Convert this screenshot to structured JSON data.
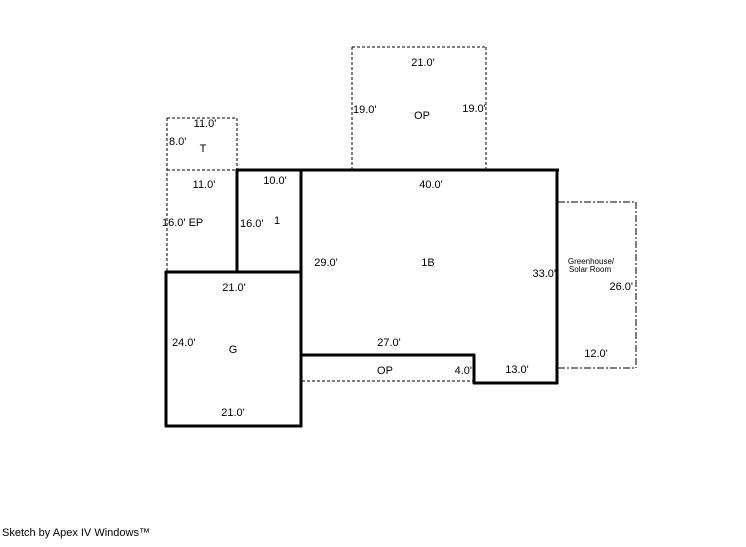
{
  "colors": {
    "line": "#000000",
    "background": "#ffffff"
  },
  "areas": {
    "op_top": {
      "name": "OP",
      "width_top": "21.0'",
      "height_left": "19.0'",
      "height_right": "19.0'"
    },
    "t": {
      "name": "T",
      "width_top": "11.0'",
      "height_left": "8.0'"
    },
    "ep": {
      "width_top": "11.0'",
      "label_left": "16.0' EP"
    },
    "one": {
      "name": "1",
      "width_top": "10.0'",
      "height_left": "16.0'"
    },
    "one_b": {
      "name": "1B",
      "width_top": "40.0'",
      "height_left": "29.0'",
      "height_right": "33.0'"
    },
    "garage": {
      "name": "G",
      "width_top": "21.0'",
      "height_left": "24.0'",
      "width_bottom": "21.0'"
    },
    "op_bottom": {
      "name": "OP",
      "width_top": "27.0'",
      "step_right": "4.0'",
      "width_right": "13.0'"
    },
    "greenhouse": {
      "name_line1": "Greenhouse/",
      "name_line2": "Solar Room",
      "height_right": "26.0'",
      "width_bottom": "12.0'"
    }
  },
  "footer": {
    "credit": "Sketch by Apex IV Windows™"
  }
}
